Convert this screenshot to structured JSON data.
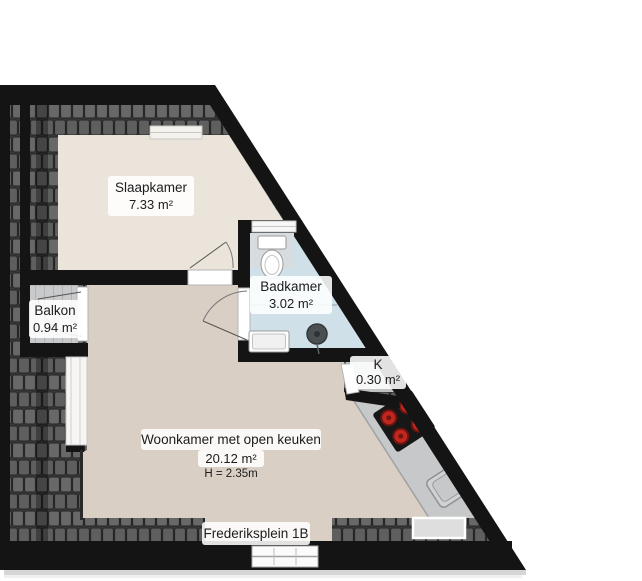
{
  "floorplan": {
    "address_label": "Frederiksplein 1B",
    "rooms": {
      "slaapkamer": {
        "name": "Slaapkamer",
        "area": "7.33 m²"
      },
      "badkamer": {
        "name": "Badkamer",
        "area": "3.02 m²"
      },
      "balkon": {
        "name": "Balkon",
        "area": "0.94 m²"
      },
      "kast": {
        "name": "K",
        "area": "0.30 m²"
      },
      "woonkamer": {
        "name": "Woonkamer met open keuken",
        "area": "20.12 m²",
        "ceiling_height": "H = 2.35m"
      }
    },
    "colors": {
      "wall": "#141414",
      "slaapkamer_floor": "#eae4da",
      "woonkamer_floor": "#d9cfc5",
      "badkamer_floor": "#cfe0e8",
      "counter": "#c6c8c9",
      "burner_red": "#c0271f",
      "roof_base": "#3a3a3a",
      "roof_tile": "#686868"
    }
  }
}
